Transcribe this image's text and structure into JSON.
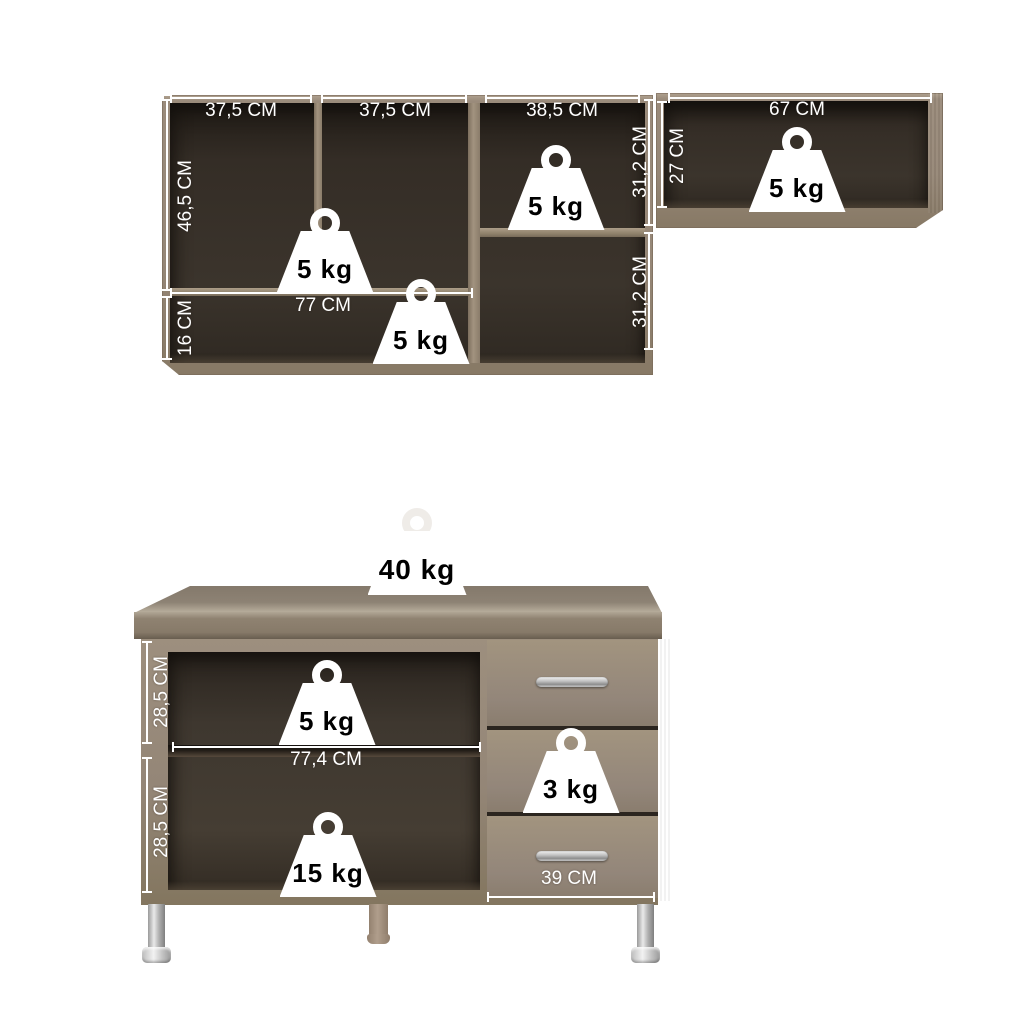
{
  "wall_unit": {
    "dim_col1": "37,5 CM",
    "dim_col2": "37,5 CM",
    "dim_col3": "38,5 CM",
    "dim_side_height": "46,5 CM",
    "dim_bottom_height": "16 CM",
    "dim_shelf_width": "77 CM",
    "dim_col3_row1_height": "31,2 CM",
    "dim_col3_row2_height": "31,2 CM",
    "weight_main_shelf": "5 kg",
    "weight_bottom_shelf": "5 kg",
    "weight_col3_shelf": "5 kg"
  },
  "wall_unit_right": {
    "dim_width": "67 CM",
    "dim_height": "27 CM",
    "weight_shelf": "5 kg"
  },
  "base_unit": {
    "weight_countertop": "40 kg",
    "dim_upper_height": "28,5 CM",
    "dim_lower_height": "28,5 CM",
    "dim_inner_width": "77,4 CM",
    "dim_drawer_width": "39 CM",
    "weight_upper_shelf": "5 kg",
    "weight_lower_shelf": "15 kg",
    "weight_drawer": "3 kg"
  },
  "colors": {
    "background": "#ffffff",
    "wood": "#98897a",
    "wood_highlight": "#b2a492",
    "wood_shadow": "#746757",
    "interior_dark": "#342d26",
    "dimension_lines": "#ffffff",
    "weight_fill": "#ffffff",
    "weight_text": "#000000",
    "chrome": "#c4c4c4",
    "leg_beige": "#a39181"
  }
}
